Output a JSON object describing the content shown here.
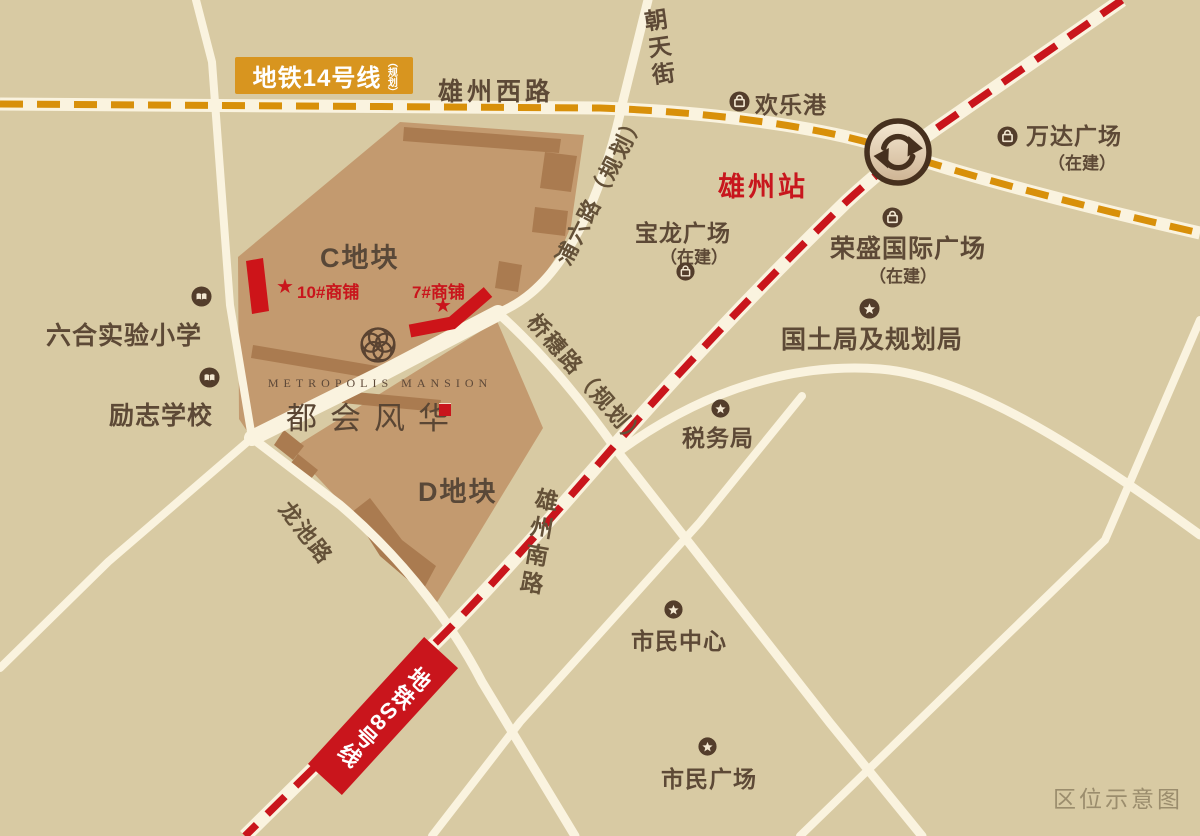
{
  "footer_title": "区位示意图",
  "metro": {
    "line14": {
      "label": "地铁14号线",
      "suffix": "（规划）"
    },
    "s8": {
      "label": "地铁S8号线"
    }
  },
  "station": {
    "name": "雄州站"
  },
  "roads": {
    "xiongzhou_west": "雄州西路",
    "chaotian": "朝天街",
    "puliu": "浦六路（规划）",
    "qiaosui": "桥穗路（规划）",
    "longchi": "龙池路",
    "xiongzhou_south": "雄州南路"
  },
  "parcels": {
    "c": "C地块",
    "d": "D地块"
  },
  "project": {
    "name_en": "METROPOLIS MANSION",
    "name_cn": "都会风华"
  },
  "shops": {
    "shop10": "10#商铺",
    "shop7": "7#商铺",
    "marker": "★"
  },
  "pois": {
    "huanlegang": {
      "name": "欢乐港"
    },
    "wanda": {
      "name": "万达广场",
      "sub": "（在建）"
    },
    "baolong": {
      "name": "宝龙广场",
      "sub": "（在建）"
    },
    "rongsheng": {
      "name": "荣盛国际广场",
      "sub": "（在建）"
    },
    "guotu": {
      "name": "国土局及规划局"
    },
    "shuiwu": {
      "name": "税务局"
    },
    "shimin_zhongxin": {
      "name": "市民中心"
    },
    "shimin_guangchang": {
      "name": "市民广场"
    },
    "liuhe": {
      "name": "六合实验小学"
    },
    "lizhi": {
      "name": "励志学校"
    }
  },
  "colors": {
    "background": "#d8caa3",
    "road": "#faf3df",
    "parcel": "#c39a6f",
    "building": "#aa7b50",
    "metro14_orange": "#d8900a",
    "metro_s8_red": "#c9151c",
    "label_box_orange": "#d8951f",
    "accent_red": "#c9151c",
    "text_brown": "#5d4936",
    "icon_brown": "#533d2b",
    "footer_grey": "#9b8d6d"
  }
}
